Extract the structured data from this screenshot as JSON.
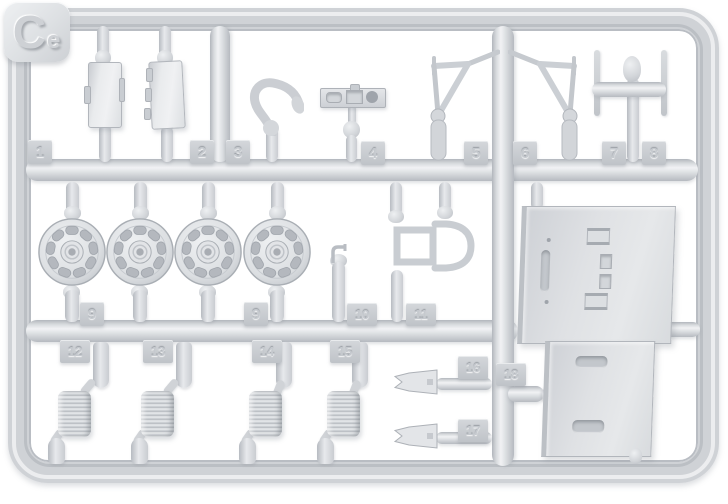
{
  "sprue_label": "Ce",
  "part_tags": [
    "1",
    "2",
    "3",
    "4",
    "5",
    "6",
    "7",
    "8",
    "9",
    "9",
    "10",
    "11",
    "12",
    "13",
    "14",
    "15",
    "16",
    "17",
    "18"
  ],
  "colors": {
    "background": "#ffffff",
    "plastic": "#d5d8db",
    "plastic_highlight": "#f0f1f3",
    "plastic_shadow": "#aeb2b8",
    "tag_face": "#c8cbd0"
  }
}
